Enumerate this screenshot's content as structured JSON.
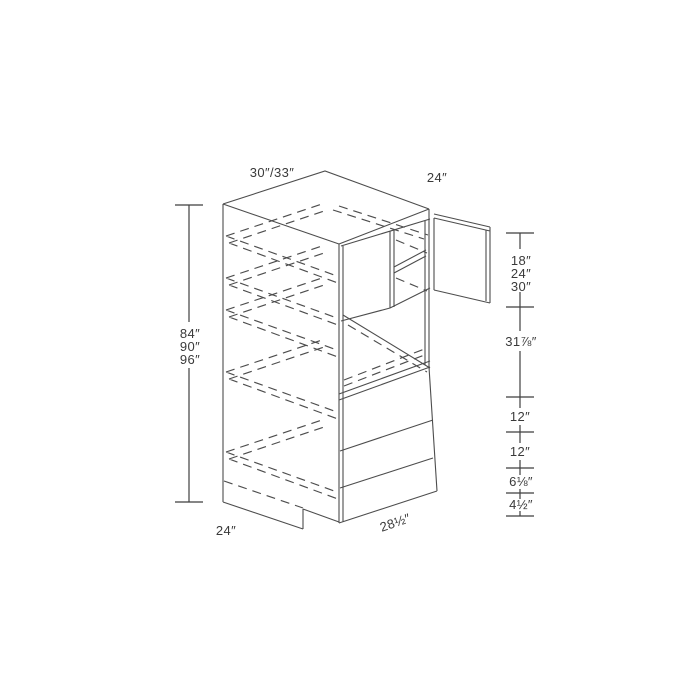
{
  "dimensions": {
    "width_options_label": "30″/33″",
    "depth_label": "24″",
    "height_options": [
      "84″",
      "90″",
      "96″"
    ],
    "top_section_heights": [
      "18″",
      "24″",
      "30″"
    ],
    "oven_opening_height": "31⅞″",
    "drawer_heights": [
      "12″",
      "12″",
      "6⅛″"
    ],
    "toe_kick_height": "4½″",
    "bottom_depth_label": "24″",
    "opening_width_label": "28½″"
  },
  "colors": {
    "line": "#4d4d4d",
    "dimension_line": "#3f3f3f",
    "text": "#3a3a3a",
    "background": "#ffffff"
  }
}
